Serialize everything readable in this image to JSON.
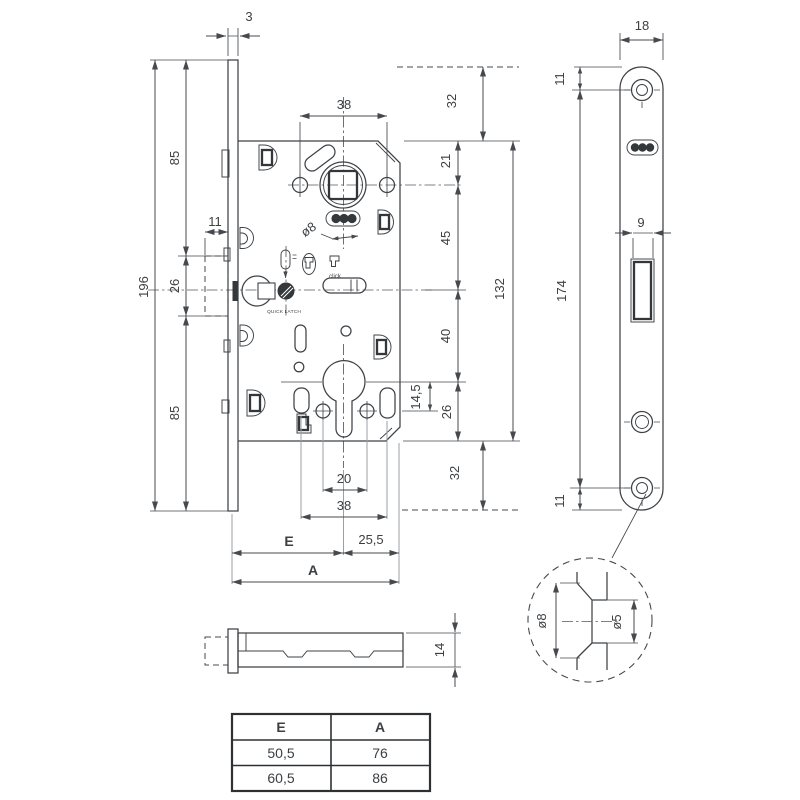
{
  "views": {
    "front": {
      "dims": {
        "plate_thickness": "3",
        "overall_height": "196",
        "upper_section": "85",
        "magnet_zone_height": "26",
        "lower_section": "85",
        "magnet_depth": "11",
        "top_holes_spacing": "38",
        "plate_top_offset": "32",
        "case_top_to_hub": "21",
        "hub_to_latch": "45",
        "case_height": "132",
        "latch_to_cylinder": "40",
        "cylinder_offset": "14,5",
        "cylinder_to_bottom": "26",
        "plate_bottom_offset": "32",
        "hole_diameter": "ø8",
        "cylinder_screws_spacing": "20",
        "lower_holes_spacing": "38",
        "backset": "E",
        "cylinder_to_back": "25,5",
        "total_depth": "A"
      },
      "labels": {
        "quick_latch": "QUICK LATCH",
        "click": "click"
      }
    },
    "faceplate": {
      "dims": {
        "width": "18",
        "top_screw_offset": "11",
        "screws_spacing": "174",
        "latch_window_width": "9",
        "bottom_screw_offset": "11"
      }
    },
    "side": {
      "dims": {
        "case_thickness": "14"
      }
    },
    "detail": {
      "dims": {
        "countersink_diameter": "ø8",
        "hole_diameter": "ø5"
      }
    }
  },
  "table": {
    "headers": [
      "E",
      "A"
    ],
    "rows": [
      [
        "50,5",
        "76"
      ],
      [
        "60,5",
        "86"
      ]
    ]
  }
}
